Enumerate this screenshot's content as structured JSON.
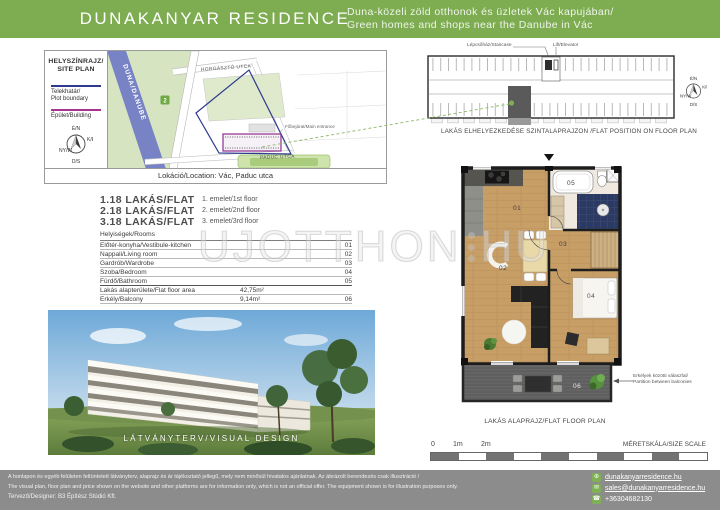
{
  "colors": {
    "accent_green": "#7DAC51",
    "footer_gray": "#8C8C8C",
    "plot_boundary_blue": "#2E3B8E",
    "building_purple": "#8F2D8F",
    "river_blue": "#7883C6",
    "highlight_gray": "#5A5A5A"
  },
  "header": {
    "title": "DUNAKANYAR RESIDENCE",
    "tagline_hu": "Duna-közeli zöld otthonok és üzletek Vác kapujában/",
    "tagline_en": "Green homes and shops near the Danube in Vác"
  },
  "compass": {
    "n": "É/N",
    "e": "K/E",
    "w": "NY/W",
    "s": "D/S"
  },
  "site_plan": {
    "title_hu": "HELYSZÍNRAJZ/",
    "title_en": "SITE PLAN",
    "legend_plot_hu": "Telekhatár/",
    "legend_plot_en": "Plot boundary",
    "legend_building": "Épület/Building",
    "river": "DUNA/DANUBE",
    "street_top": "HORGÁSZTÓ UTCA",
    "street_bottom": "PADUC UTCA",
    "route_badge": "2",
    "main_entrance": "Főbejárat/Main entrance",
    "location": "Lokáció/Location: Vác, Paduc utca"
  },
  "flats": [
    {
      "id": "1.18 LAKÁS/FLAT",
      "floor": "1. emelet/1st floor"
    },
    {
      "id": "2.18 LAKÁS/FLAT",
      "floor": "2. emelet/2nd floor"
    },
    {
      "id": "3.18 LAKÁS/FLAT",
      "floor": "3. emelet/3rd floor"
    }
  ],
  "rooms": {
    "header": "Helyiségek/Rooms",
    "rows": [
      {
        "label": "Előtér-konyha/Vestibule-kitchen",
        "value": "",
        "num": "01"
      },
      {
        "label": "Nappali/Living room",
        "value": "",
        "num": "02"
      },
      {
        "label": "Gardrób/Wardrobe",
        "value": "",
        "num": "03"
      },
      {
        "label": "Szoba/Bedroom",
        "value": "",
        "num": "04"
      },
      {
        "label": "Fürdő/Bathroom",
        "value": "",
        "num": "05"
      },
      {
        "label": "Lakás alapterülete/Flat floor area",
        "value": "42,75m²",
        "num": ""
      },
      {
        "label": "Erkély/Balcony",
        "value": "9,14m²",
        "num": "06"
      }
    ]
  },
  "photo": {
    "caption": "LÁTVÁNYTERV/VISUAL DESIGN"
  },
  "position_plan": {
    "staircase": "Lépcsőház/Staircase",
    "elevator": "Lift/Elevator",
    "caption": "LAKÁS ELHELYEZKEDÉSE SZINTALAPRAJZON /FLAT POSITION ON FLOOR PLAN"
  },
  "floor_plan": {
    "caption": "LAKÁS ALAPRAJZ/FLAT FLOOR PLAN",
    "labels": {
      "r01": "01",
      "r02": "02",
      "r03": "03",
      "r04": "04",
      "r05": "05",
      "r06": "06"
    },
    "partition_hu": "Erkélyek közötti válaszfal/",
    "partition_en": "Partition between balconies"
  },
  "scale": {
    "t0": "0",
    "t1": "1m",
    "t2": "2m",
    "label": "MÉRETSKÁLA/SIZE SCALE"
  },
  "watermark": {
    "part1": "UJOTTHON",
    "part2": "HU"
  },
  "footer": {
    "disclaimer_hu": "A honlapon és egyéb felületen feltüntetett látványterv, alaprajz és ár tájékoztató jellegű, mely nem minősül hivatalos ajánlatnak. Az ábrázolt berendezés csak illusztráció /",
    "disclaimer_en": "The visual plan, floor plan and price shown on the website and other platforms are for information only, which is not an official offer. The equipment shown is for illustration purposes only.",
    "designer": "Tervező/Designer: B3 Építész Stúdió Kft.",
    "website": "dunakanyarresidence.hu",
    "email": "sales@dunakanyarresidence.hu",
    "phone": "+36304682130"
  }
}
